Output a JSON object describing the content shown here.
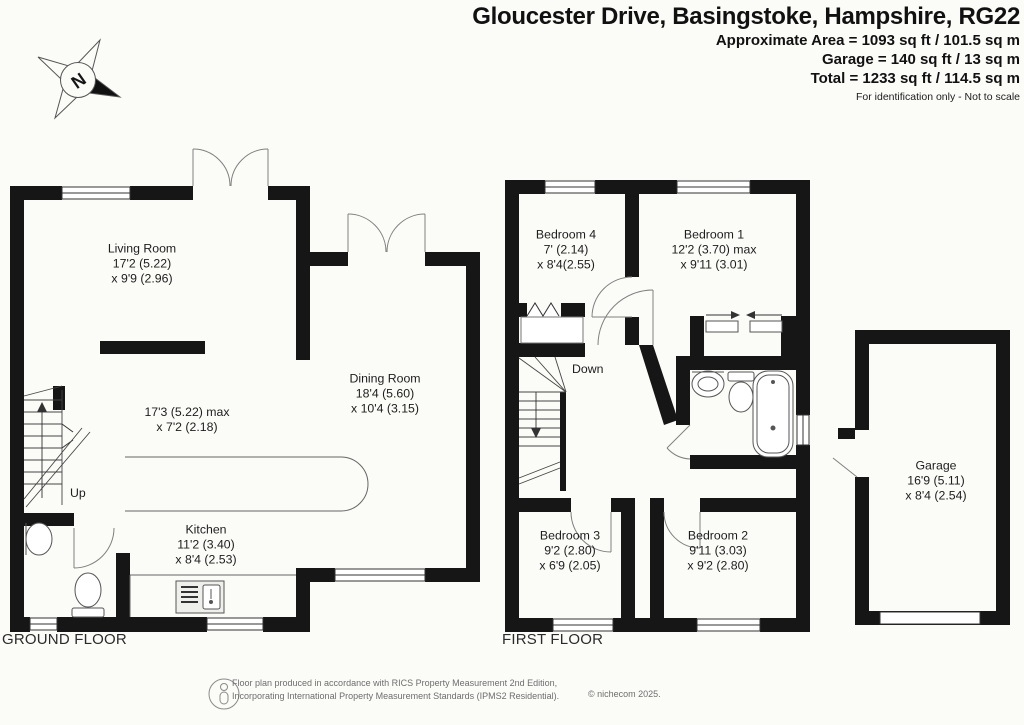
{
  "header": {
    "title": "Gloucester Drive, Basingstoke, Hampshire, RG22",
    "area_line1": "Approximate Area = 1093 sq ft / 101.5 sq m",
    "area_line2": "Garage = 140 sq ft / 13 sq m",
    "area_line3": "Total = 1233 sq ft / 114.5 sq m",
    "disclaimer": "For identification only - Not to scale"
  },
  "compass": {
    "north_label": "N"
  },
  "floor_titles": {
    "ground": "GROUND FLOOR",
    "first": "FIRST FLOOR"
  },
  "stairs": {
    "up": "Up",
    "down": "Down"
  },
  "rooms": {
    "living": {
      "name": "Living Room",
      "dim1": "17'2 (5.22)",
      "dim2": "x 9'9 (2.96)"
    },
    "hall": {
      "dim1": "17'3 (5.22) max",
      "dim2": "x 7'2 (2.18)"
    },
    "dining": {
      "name": "Dining Room",
      "dim1": "18'4 (5.60)",
      "dim2": "x 10'4 (3.15)"
    },
    "kitchen": {
      "name": "Kitchen",
      "dim1": "11'2 (3.40)",
      "dim2": "x 8'4 (2.53)"
    },
    "bed4": {
      "name": "Bedroom 4",
      "dim1": "7' (2.14)",
      "dim2": "x 8'4(2.55)"
    },
    "bed1": {
      "name": "Bedroom 1",
      "dim1": "12'2 (3.70) max",
      "dim2": "x 9'11 (3.01)"
    },
    "bed3": {
      "name": "Bedroom 3",
      "dim1": "9'2 (2.80)",
      "dim2": "x 6'9 (2.05)"
    },
    "bed2": {
      "name": "Bedroom 2",
      "dim1": "9'11 (3.03)",
      "dim2": "x 9'2 (2.80)"
    },
    "garage": {
      "name": "Garage",
      "dim1": "16'9 (5.11)",
      "dim2": "x 8'4 (2.54)"
    }
  },
  "footer": {
    "line1": "Floor plan produced in accordance with RICS Property Measurement 2nd Edition,",
    "line2": "Incorporating International Property Measurement Standards (IPMS2 Residential).",
    "copyright": "© nichecom 2025."
  },
  "colors": {
    "wall": "#161616",
    "line": "#555555",
    "door_arc": "#808080"
  }
}
